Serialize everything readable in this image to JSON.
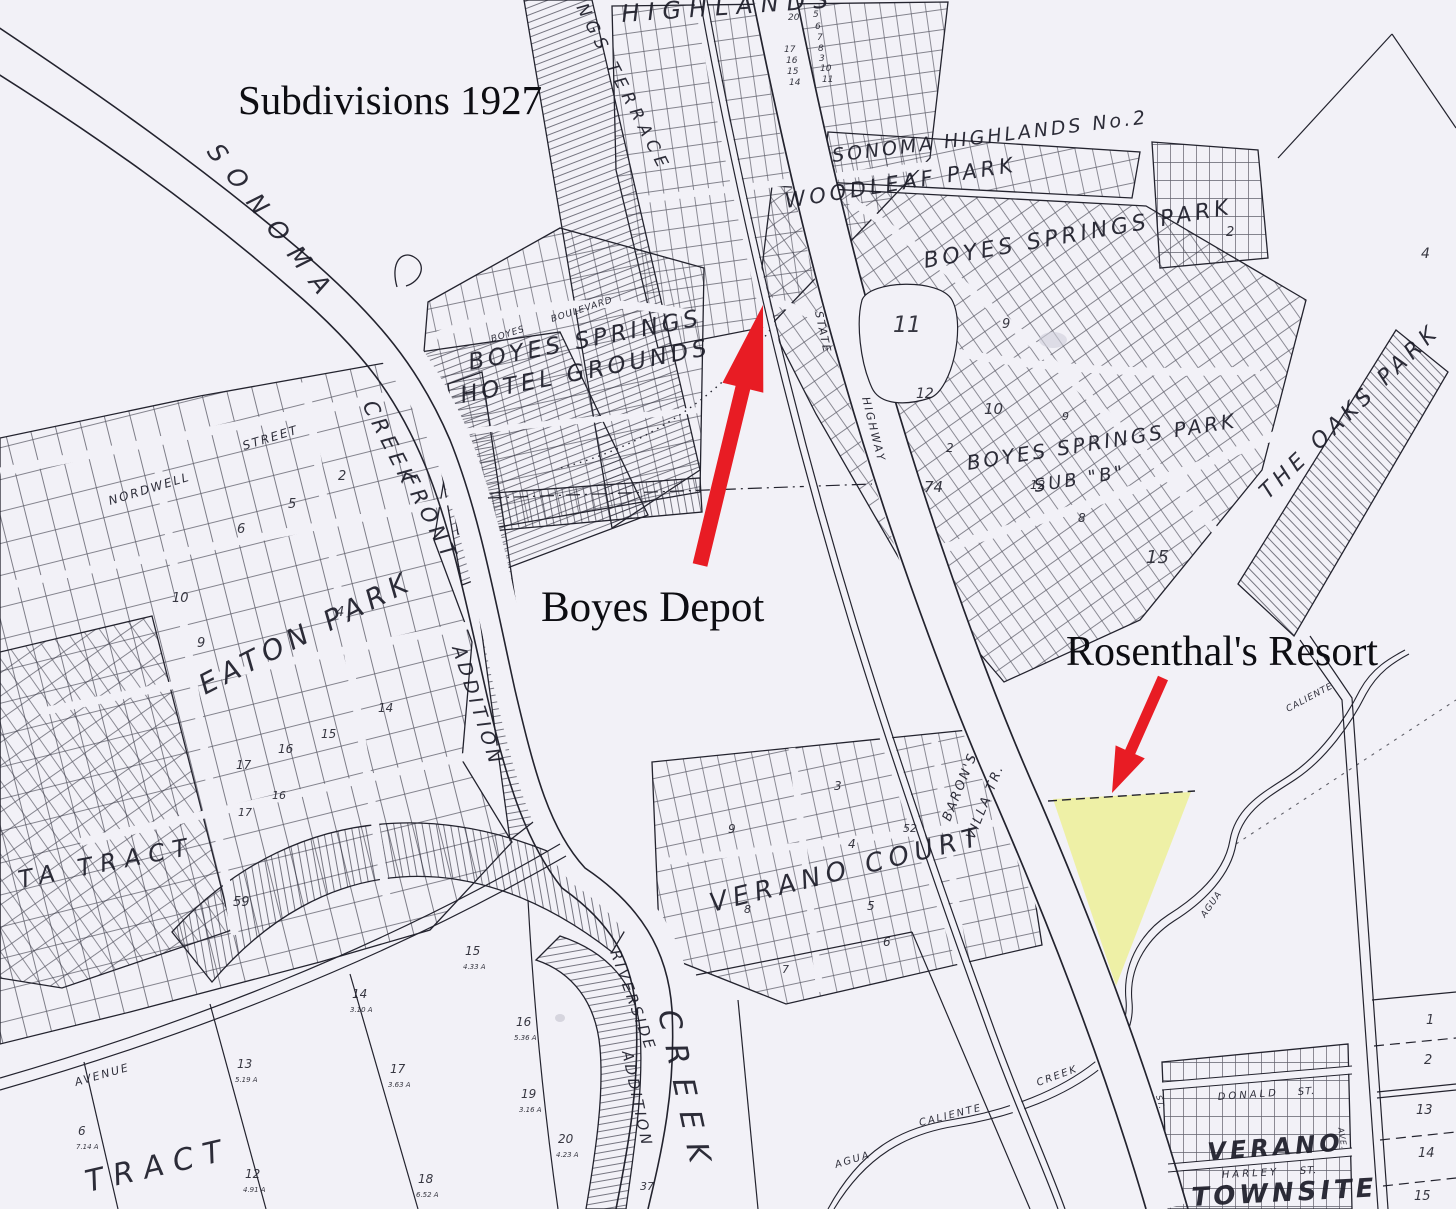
{
  "annotations": {
    "title": "Subdivisions 1927",
    "boyes_depot": "Boyes Depot",
    "rosenthals_resort": "Rosenthal's Resort"
  },
  "colors": {
    "paper": "#f2f1f7",
    "ink": "#23232e",
    "arrow_red": "#e81c24",
    "resort_highlight": "#eef0a6"
  },
  "map": {
    "labels": [
      {
        "text": "SONOMA",
        "x": 206,
        "y": 152,
        "size": 25,
        "rot": 52,
        "ls": 14
      },
      {
        "text": "SPRINGS TERRACE",
        "x": 548,
        "y": -48,
        "size": 17,
        "rot": 63,
        "ls": 6
      },
      {
        "text": "HIGHLANDS",
        "x": 622,
        "y": 22,
        "size": 24,
        "rot": -4,
        "ls": 8
      },
      {
        "text": "SONOMA HIGHLANDS No.2",
        "x": 833,
        "y": 162,
        "size": 19,
        "rot": -7,
        "ls": 3
      },
      {
        "text": "WOODLEAF  PARK",
        "x": 786,
        "y": 208,
        "size": 21,
        "rot": -9,
        "ls": 4
      },
      {
        "text": "BOYES  SPRINGS  PARK",
        "x": 925,
        "y": 268,
        "size": 22,
        "rot": -10,
        "ls": 4
      },
      {
        "text": "BOYES SPRINGS PARK",
        "x": 968,
        "y": 470,
        "size": 20,
        "rot": -9,
        "ls": 3
      },
      {
        "text": "SUB \"B\"",
        "x": 1035,
        "y": 492,
        "size": 18,
        "rot": -9,
        "ls": 3
      },
      {
        "text": "THE OAKS PARK",
        "x": 1268,
        "y": 500,
        "size": 22,
        "rot": -44,
        "ls": 5
      },
      {
        "text": "BOYES  SPRINGS",
        "x": 470,
        "y": 370,
        "size": 23,
        "rot": -11,
        "ls": 4
      },
      {
        "text": "HOTEL  GROUNDS",
        "x": 462,
        "y": 403,
        "size": 23,
        "rot": -11,
        "ls": 4
      },
      {
        "text": "BOYES",
        "x": 492,
        "y": 342,
        "size": 9,
        "rot": -18,
        "ls": 1
      },
      {
        "text": "BOULEVARD",
        "x": 552,
        "y": 322,
        "size": 9,
        "rot": -18,
        "ls": 1
      },
      {
        "text": "STATE",
        "x": 815,
        "y": 312,
        "size": 11,
        "rot": 78,
        "ls": 2
      },
      {
        "text": "HIGHWAY",
        "x": 862,
        "y": 398,
        "size": 11,
        "rot": 76,
        "ls": 2
      },
      {
        "text": "NORDWELL",
        "x": 110,
        "y": 505,
        "size": 12,
        "rot": -17,
        "ls": 2
      },
      {
        "text": "STREET",
        "x": 244,
        "y": 450,
        "size": 12,
        "rot": -17,
        "ls": 2
      },
      {
        "text": "EATON  PARK",
        "x": 205,
        "y": 695,
        "size": 28,
        "rot": -27,
        "ls": 6
      },
      {
        "text": "CREEK",
        "x": 362,
        "y": 405,
        "size": 21,
        "rot": 63,
        "ls": 5
      },
      {
        "text": "FRONT",
        "x": 402,
        "y": 478,
        "size": 21,
        "rot": 63,
        "ls": 5
      },
      {
        "text": "ADDITION",
        "x": 452,
        "y": 648,
        "size": 19,
        "rot": 72,
        "ls": 4
      },
      {
        "text": "TA  TRACT",
        "x": 20,
        "y": 888,
        "size": 24,
        "rot": -11,
        "ls": 8
      },
      {
        "text": "TRACT",
        "x": 88,
        "y": 1192,
        "size": 30,
        "rot": -13,
        "ls": 10
      },
      {
        "text": "AVENUE",
        "x": 76,
        "y": 1086,
        "size": 11,
        "rot": -16,
        "ls": 2
      },
      {
        "text": "VERANO  COURT",
        "x": 712,
        "y": 912,
        "size": 26,
        "rot": -14,
        "ls": 6
      },
      {
        "text": "BARON'S",
        "x": 950,
        "y": 822,
        "size": 13,
        "rot": -68,
        "ls": 2
      },
      {
        "text": "VILLA TR.",
        "x": 974,
        "y": 840,
        "size": 13,
        "rot": -68,
        "ls": 2
      },
      {
        "text": "RIVERSIDE",
        "x": 610,
        "y": 952,
        "size": 15,
        "rot": 70,
        "ls": 3
      },
      {
        "text": "ADDITION",
        "x": 622,
        "y": 1052,
        "size": 15,
        "rot": 78,
        "ls": 3
      },
      {
        "text": "CREEK",
        "x": 658,
        "y": 1012,
        "size": 30,
        "rot": 78,
        "ls": 14
      },
      {
        "text": "AGUA",
        "x": 836,
        "y": 1168,
        "size": 10,
        "rot": -17,
        "ls": 2
      },
      {
        "text": "CALIENTE",
        "x": 920,
        "y": 1126,
        "size": 10,
        "rot": -14,
        "ls": 2
      },
      {
        "text": "CREEK",
        "x": 1038,
        "y": 1086,
        "size": 10,
        "rot": -20,
        "ls": 2
      },
      {
        "text": "AGUA",
        "x": 1205,
        "y": 918,
        "size": 9,
        "rot": -55,
        "ls": 1
      },
      {
        "text": "CALIENTE",
        "x": 1288,
        "y": 712,
        "size": 9,
        "rot": -28,
        "ls": 1
      },
      {
        "text": "DONALD",
        "x": 1218,
        "y": 1100,
        "size": 10,
        "rot": -4,
        "ls": 3
      },
      {
        "text": "ST.",
        "x": 1298,
        "y": 1095,
        "size": 10,
        "rot": -4,
        "ls": 1
      },
      {
        "text": "VERANO",
        "x": 1208,
        "y": 1160,
        "size": 24,
        "rot": -4,
        "ls": 4,
        "bold": true
      },
      {
        "text": "HARLEY",
        "x": 1222,
        "y": 1178,
        "size": 10,
        "rot": -3,
        "ls": 3
      },
      {
        "text": "ST.",
        "x": 1300,
        "y": 1174,
        "size": 10,
        "rot": -3,
        "ls": 1
      },
      {
        "text": "TOWNSITE",
        "x": 1192,
        "y": 1206,
        "size": 26,
        "rot": -3,
        "ls": 4,
        "bold": true
      },
      {
        "text": "ST.",
        "x": 1156,
        "y": 1096,
        "size": 8,
        "rot": 75,
        "ls": 1
      },
      {
        "text": "AVE.",
        "x": 1338,
        "y": 1128,
        "size": 8,
        "rot": 80,
        "ls": 1
      }
    ],
    "block_numbers": [
      {
        "t": "20",
        "x": 788,
        "y": 20,
        "s": 9
      },
      {
        "t": "5",
        "x": 813,
        "y": 17,
        "s": 9
      },
      {
        "t": "6",
        "x": 815,
        "y": 29,
        "s": 9
      },
      {
        "t": "7",
        "x": 817,
        "y": 40,
        "s": 9
      },
      {
        "t": "8",
        "x": 818,
        "y": 51,
        "s": 9
      },
      {
        "t": "3",
        "x": 819,
        "y": 61,
        "s": 9
      },
      {
        "t": "10",
        "x": 820,
        "y": 71,
        "s": 9
      },
      {
        "t": "11",
        "x": 822,
        "y": 82,
        "s": 9
      },
      {
        "t": "17",
        "x": 784,
        "y": 52,
        "s": 9
      },
      {
        "t": "16",
        "x": 786,
        "y": 63,
        "s": 9
      },
      {
        "t": "15",
        "x": 787,
        "y": 74,
        "s": 9
      },
      {
        "t": "14",
        "x": 789,
        "y": 85,
        "s": 9
      },
      {
        "t": "11",
        "x": 893,
        "y": 332,
        "s": 22
      },
      {
        "t": "12",
        "x": 916,
        "y": 398,
        "s": 14
      },
      {
        "t": "10",
        "x": 984,
        "y": 414,
        "s": 15
      },
      {
        "t": "74",
        "x": 924,
        "y": 492,
        "s": 15
      },
      {
        "t": "9",
        "x": 1002,
        "y": 328,
        "s": 13
      },
      {
        "t": "2",
        "x": 946,
        "y": 452,
        "s": 12
      },
      {
        "t": "15",
        "x": 1146,
        "y": 563,
        "s": 18
      },
      {
        "t": "8",
        "x": 1078,
        "y": 522,
        "s": 12
      },
      {
        "t": "12",
        "x": 1030,
        "y": 489,
        "s": 12
      },
      {
        "t": "9",
        "x": 1062,
        "y": 420,
        "s": 11
      },
      {
        "t": "2",
        "x": 1226,
        "y": 236,
        "s": 13
      },
      {
        "t": "4",
        "x": 1421,
        "y": 258,
        "s": 14
      },
      {
        "t": "2",
        "x": 338,
        "y": 480,
        "s": 13
      },
      {
        "t": "5",
        "x": 288,
        "y": 508,
        "s": 13
      },
      {
        "t": "6",
        "x": 237,
        "y": 533,
        "s": 13
      },
      {
        "t": "10",
        "x": 172,
        "y": 602,
        "s": 13
      },
      {
        "t": "9",
        "x": 197,
        "y": 647,
        "s": 13
      },
      {
        "t": "4",
        "x": 336,
        "y": 616,
        "s": 13
      },
      {
        "t": "14",
        "x": 378,
        "y": 712,
        "s": 12
      },
      {
        "t": "15",
        "x": 321,
        "y": 738,
        "s": 12
      },
      {
        "t": "16",
        "x": 278,
        "y": 753,
        "s": 12
      },
      {
        "t": "17",
        "x": 236,
        "y": 769,
        "s": 12
      },
      {
        "t": "16",
        "x": 272,
        "y": 799,
        "s": 11
      },
      {
        "t": "17",
        "x": 238,
        "y": 816,
        "s": 11
      },
      {
        "t": "59",
        "x": 233,
        "y": 906,
        "s": 13
      },
      {
        "t": "9",
        "x": 728,
        "y": 833,
        "s": 12
      },
      {
        "t": "3",
        "x": 834,
        "y": 790,
        "s": 12
      },
      {
        "t": "4",
        "x": 848,
        "y": 848,
        "s": 12
      },
      {
        "t": "52",
        "x": 903,
        "y": 832,
        "s": 11
      },
      {
        "t": "5",
        "x": 867,
        "y": 910,
        "s": 12
      },
      {
        "t": "8",
        "x": 744,
        "y": 913,
        "s": 11
      },
      {
        "t": "6",
        "x": 883,
        "y": 946,
        "s": 12
      },
      {
        "t": "7",
        "x": 782,
        "y": 973,
        "s": 11
      },
      {
        "t": "15",
        "x": 465,
        "y": 955,
        "s": 12
      },
      {
        "t": "4.33 A",
        "x": 463,
        "y": 969,
        "s": 7
      },
      {
        "t": "14",
        "x": 352,
        "y": 998,
        "s": 12
      },
      {
        "t": "3.10 A",
        "x": 350,
        "y": 1012,
        "s": 7
      },
      {
        "t": "16",
        "x": 516,
        "y": 1026,
        "s": 12
      },
      {
        "t": "5.36 A",
        "x": 514,
        "y": 1040,
        "s": 7
      },
      {
        "t": "13",
        "x": 237,
        "y": 1068,
        "s": 12
      },
      {
        "t": "5.19 A",
        "x": 235,
        "y": 1082,
        "s": 7
      },
      {
        "t": "17",
        "x": 390,
        "y": 1073,
        "s": 12
      },
      {
        "t": "3.63 A",
        "x": 388,
        "y": 1087,
        "s": 7
      },
      {
        "t": "19",
        "x": 521,
        "y": 1098,
        "s": 12
      },
      {
        "t": "3.16 A",
        "x": 519,
        "y": 1112,
        "s": 7
      },
      {
        "t": "6",
        "x": 78,
        "y": 1135,
        "s": 12
      },
      {
        "t": "7.14 A",
        "x": 76,
        "y": 1149,
        "s": 7
      },
      {
        "t": "12",
        "x": 245,
        "y": 1178,
        "s": 12
      },
      {
        "t": "4.91 A",
        "x": 243,
        "y": 1192,
        "s": 7
      },
      {
        "t": "18",
        "x": 418,
        "y": 1183,
        "s": 12
      },
      {
        "t": "6.52 A",
        "x": 416,
        "y": 1197,
        "s": 7
      },
      {
        "t": "20",
        "x": 558,
        "y": 1143,
        "s": 12
      },
      {
        "t": "4.23 A",
        "x": 556,
        "y": 1157,
        "s": 7
      },
      {
        "t": "1",
        "x": 1426,
        "y": 1024,
        "s": 13
      },
      {
        "t": "2",
        "x": 1424,
        "y": 1064,
        "s": 13
      },
      {
        "t": "13",
        "x": 1416,
        "y": 1114,
        "s": 13
      },
      {
        "t": "14",
        "x": 1418,
        "y": 1157,
        "s": 13
      },
      {
        "t": "15",
        "x": 1414,
        "y": 1200,
        "s": 13
      },
      {
        "t": "37",
        "x": 640,
        "y": 1190,
        "s": 11
      }
    ]
  }
}
